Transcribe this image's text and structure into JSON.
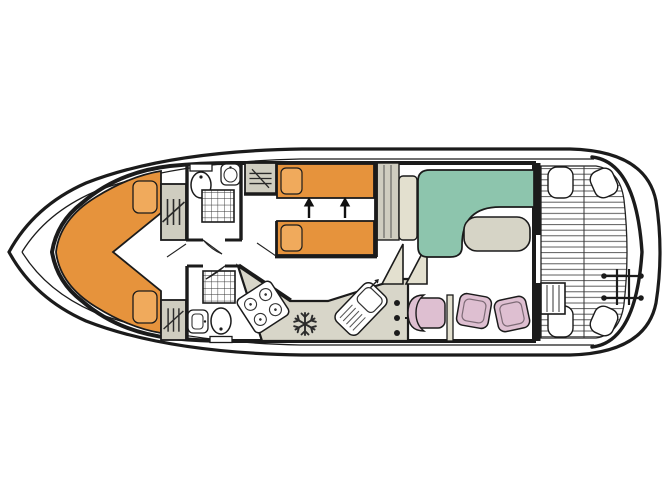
{
  "colors": {
    "line": "#1b1b1b",
    "hull_white": "#ffffff",
    "floor_cream": "#eae7d3",
    "panel_light": "#e3e0cf",
    "bed_orange": "#e6933c",
    "pillow_orange": "#f0aa5c",
    "furniture_grey": "#cfcdc0",
    "counter_grey": "#d8d6c9",
    "sofa_teal": "#8dc5ad",
    "table_grey": "#d6d4c6",
    "chair_pink": "#debfd1",
    "fixture_white": "#ffffff",
    "deck_slat": "#4a4a4a"
  },
  "plan": {
    "type": "boat-floor-plan",
    "view": "top-down-deck-plan",
    "orientation": "bow-left-stern-right",
    "rooms": [
      {
        "name": "bow-cabin",
        "furniture": [
          "v-double-berth",
          "pillow",
          "pillow",
          "wardrobe-port",
          "wardrobe-starboard"
        ]
      },
      {
        "name": "shower-room-forward",
        "furniture": [
          "toilet",
          "washbasin",
          "shower"
        ]
      },
      {
        "name": "twin-cabin",
        "furniture": [
          "single-bed-port",
          "single-bed-starboard",
          "pillow",
          "pillow",
          "wardrobe",
          "beds-join-arrow",
          "beds-join-arrow"
        ]
      },
      {
        "name": "shower-room-aft",
        "furniture": [
          "shower",
          "washbasin",
          "toilet"
        ]
      },
      {
        "name": "galley",
        "furniture": [
          "worktop",
          "four-burner-hob",
          "refrigerator-snowflake",
          "sink-with-drainer"
        ]
      },
      {
        "name": "helm-station",
        "furniture": [
          "instrument-console",
          "steering-wheel",
          "helm-chair",
          "stool",
          "stool",
          "partition"
        ]
      },
      {
        "name": "saloon",
        "furniture": [
          "l-shaped-sofa",
          "sofa-backrest",
          "table",
          "companionway-steps",
          "cupboard"
        ]
      },
      {
        "name": "aft-deck",
        "furniture": [
          "slatted-floor",
          "corner-seat",
          "corner-seat",
          "corner-seat",
          "corner-seat",
          "engine-hatch-steps",
          "stern-ladder"
        ]
      }
    ]
  }
}
